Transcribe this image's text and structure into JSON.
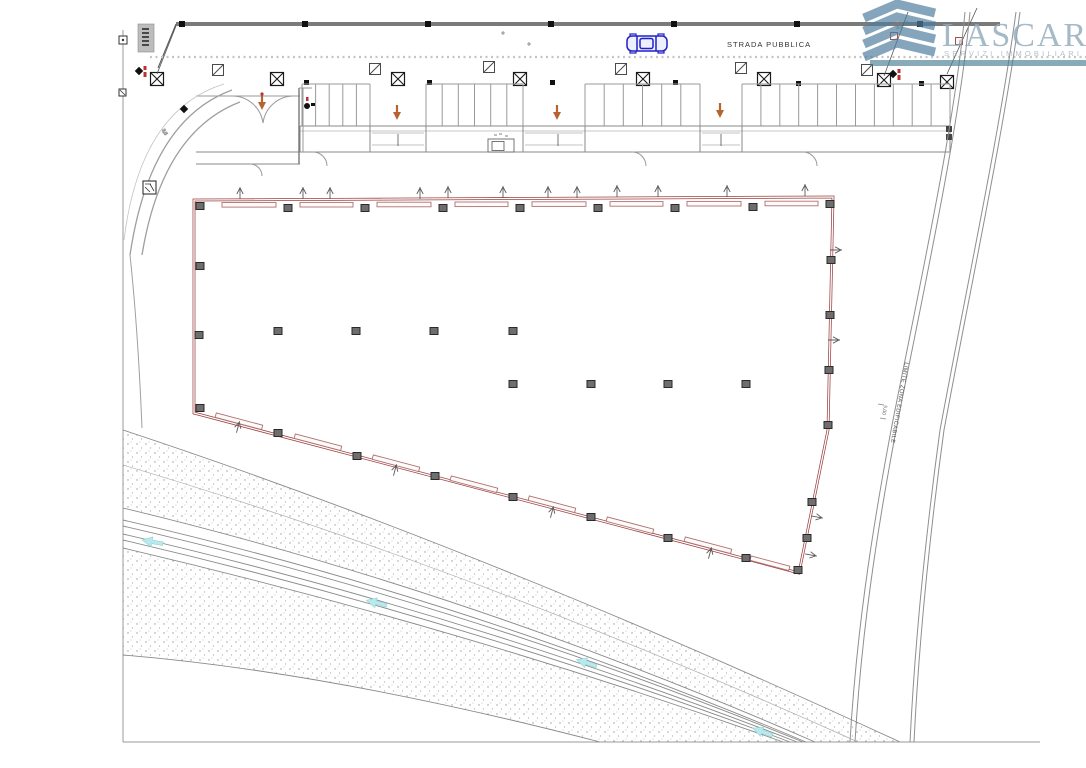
{
  "logo": {
    "name": "LASCARI",
    "tagline": "SERVIZI IMMOBILIARI",
    "icon": "building-chevrons-icon",
    "accent_color": "#4a7f96",
    "text_color": "#93aabb"
  },
  "labels": {
    "road": "STRADA PUBBLICA",
    "buildable_limit": "LIMITE ZONA EDIFICABILE",
    "dimension_note": "5,00",
    "elevation_note": "43.82"
  },
  "colors": {
    "parcel_outline": "#9c3f3f",
    "orange_arrow": "#b5642f",
    "cyan_arrow": "#b9e9ec",
    "drawing_line": "#8a8a8a",
    "dark_detail": "#1a1a1a",
    "car_blue": "#2020c8"
  }
}
